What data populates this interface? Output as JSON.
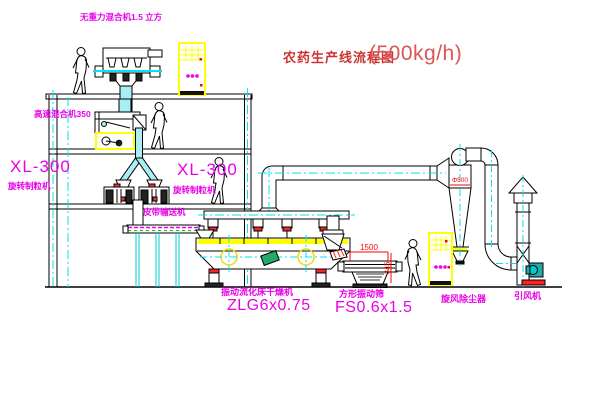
{
  "title": {
    "prefix": "农药生产线流程图",
    "capacity": "(500kg/h)"
  },
  "labels": {
    "gravity_mixer": "无重力混合机1.5 立方",
    "high_speed_mixer": "高速混合机350",
    "granulator_left_model": "XL-300",
    "granulator_left_name": "旋转制粒机",
    "granulator_right_model": "XL-300",
    "granulator_right_name": "旋转制粒机",
    "belt_conveyor": "皮带输送机",
    "dryer_name": "振动流化床干燥机",
    "dryer_model": "ZLG6x0.75",
    "screen_name": "方形振动筛",
    "screen_model": "FS0.6x1.5",
    "cyclone": "旋风除尘器",
    "fan": "引风机"
  },
  "dimensions": {
    "screen_length": "1500",
    "screen_height": "345",
    "cyclone_dia": "Φ500"
  },
  "colors": {
    "label_magenta": "#e800e8",
    "title_red": "#cc3333",
    "dim_red": "#ff0000",
    "pipe_cyan": "#00e5ee",
    "chute_fill": "#aaeef5",
    "cabinet_yellow": "#ffff00",
    "motor_green": "#22aa66",
    "fan_teal": "#22aaaa"
  }
}
